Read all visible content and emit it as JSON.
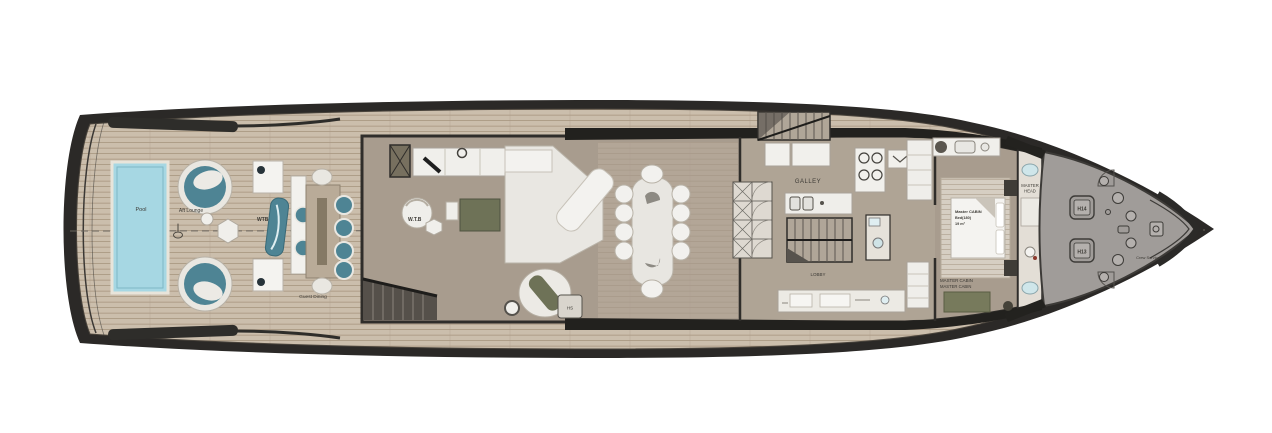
{
  "plan": {
    "labels": {
      "pool": "Pool",
      "aft_lounge": "Aft Lounge",
      "wtb_aft": "WTB",
      "guest_dining": "Guest Dining",
      "wtb_salon": "W.T.B",
      "hs": "HS",
      "galley": "GALLEY",
      "lobby": "LOBBY",
      "master_bed_line1": "Master CABIN",
      "master_bed_line2": "Bed(180)",
      "master_bed_line3": "19 m²",
      "master_cabin_1": "MASTER CABIN",
      "master_cabin_2": "MASTER CABIN",
      "master_head_1": "MASTER",
      "master_head_2": "HEAD",
      "h14": "H14",
      "h13": "H13",
      "crew_service": "Crew Service"
    },
    "colors": {
      "hull": "#2b2927",
      "teak_deck": "#cbbeac",
      "interior_floor": "#a89c8e",
      "galley_floor": "#b2a797",
      "foredeck": "#a09c99",
      "pool_water": "#a6d7e3",
      "teal_furniture": "#4e8494",
      "olive_furniture": "#6e7257",
      "white_furniture": "#f0efeb"
    }
  }
}
